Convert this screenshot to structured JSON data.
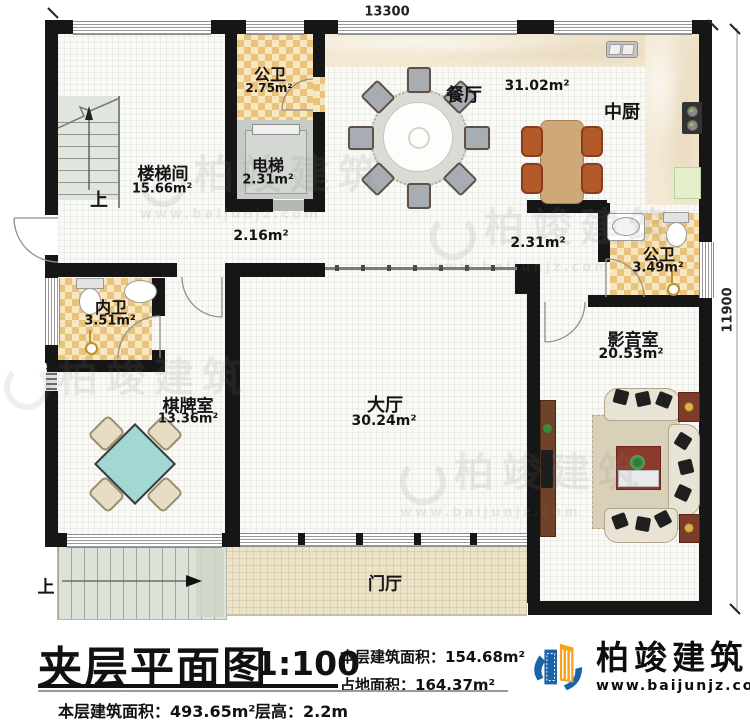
{
  "dimensions": {
    "top": "13300",
    "right": "11900"
  },
  "rooms": {
    "stair_hall": {
      "name": "楼梯间",
      "area": "15.66m²"
    },
    "bath_top": {
      "name": "公卫",
      "area": "2.75m²"
    },
    "elevator": {
      "name": "电梯",
      "area": "2.31m²"
    },
    "dining": {
      "name": "餐厅",
      "area": "31.02m²"
    },
    "kitchen": {
      "name": "中厨"
    },
    "bath_right": {
      "name": "公卫",
      "area": "3.49m²"
    },
    "bath_inner": {
      "name": "内卫",
      "area": "3.51m²"
    },
    "media": {
      "name": "影音室",
      "area": "20.53m²"
    },
    "games": {
      "name": "棋牌室",
      "area": "13.36m²"
    },
    "hall": {
      "name": "大厅",
      "area": "30.24m²"
    },
    "foyer": {
      "name": "门厅"
    },
    "corridor_left_area": "2.16m²",
    "corridor_right_area": "2.31m²",
    "stairs_up_top": "上",
    "stairs_up_bottom": "上"
  },
  "title_block": {
    "title": "夹层平面图",
    "scale": "1:100",
    "floor_area": "本层建筑面积：154.68m²",
    "land_area": "占地面积：164.37m²",
    "level_area": "本层建筑面积：493.65m²",
    "level_height": "层高：2.2m"
  },
  "logo": {
    "company": "柏竣建筑",
    "website": "www.baijunjz.com"
  },
  "watermark": {
    "text": "柏竣建筑",
    "url": "www.baijunjz.com"
  },
  "colors": {
    "wall": "#161616",
    "checker_tan": "#e9c27c",
    "marble": "#f2e8d3",
    "foyer_beige": "#ece3c9",
    "games_table_teal": "#a2d8d3",
    "logo_blue": "#1b63a8",
    "logo_orange": "#f7a219"
  }
}
